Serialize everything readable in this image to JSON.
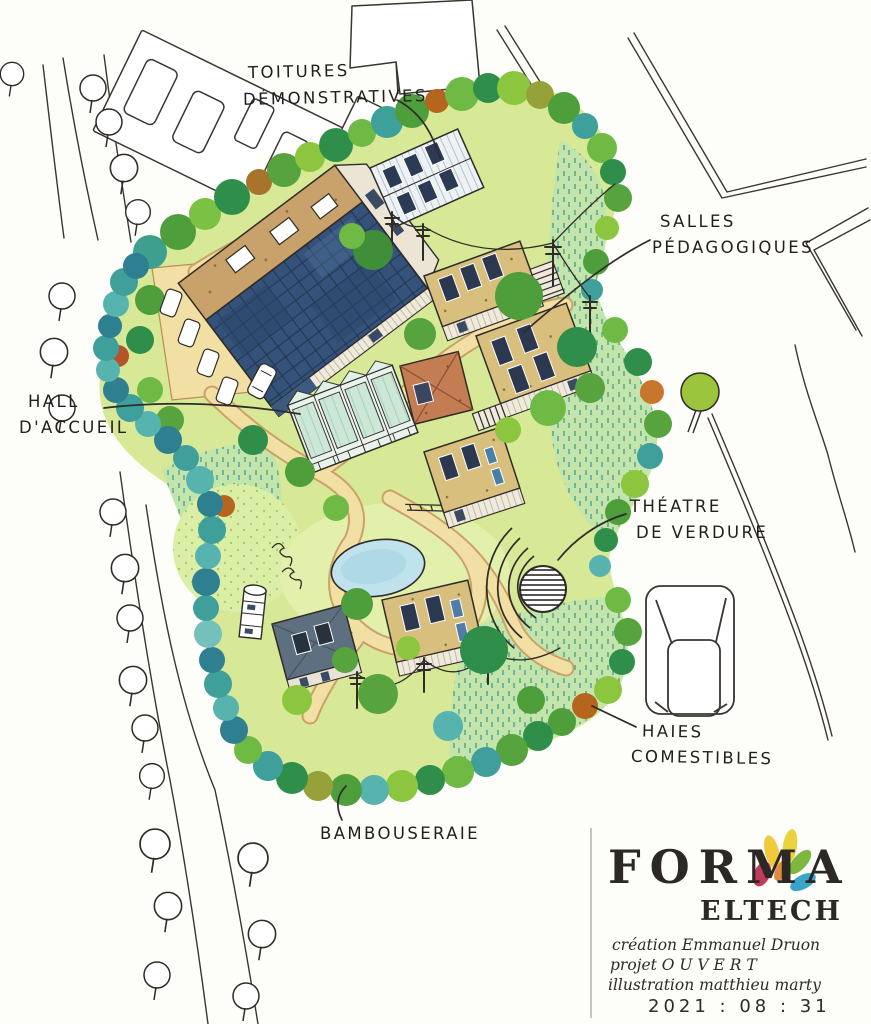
{
  "annotations": {
    "toitures": {
      "line1": "TOITURES",
      "line2": "DÉMONSTRATIVES"
    },
    "salles": {
      "line1": "SALLES",
      "line2": "PÉDAGOGIQUES"
    },
    "hall": {
      "line1": "HALL",
      "line2": "D'ACCUEIL"
    },
    "theatre": {
      "line1": "THÉATRE",
      "line2": "DE VERDURE"
    },
    "haies": {
      "line1": "HAIES",
      "line2": "COMESTIBLES"
    },
    "bambouseraie": {
      "line1": "BAMBOUSERAIE"
    }
  },
  "logo": {
    "brand": "FORMA",
    "sub": "ELTECH"
  },
  "credits": {
    "line1": "création Emmanuel Druon",
    "line2": "projet O U V E R T",
    "line3": "illustration matthieu marty",
    "line4": "2021 : 08 : 31"
  },
  "colors": {
    "ink": "#2f2b28",
    "campus_green": "#d7e897",
    "path_sand": "#f1dfa3",
    "pond_blue": "#bfe2ec",
    "solar_roof_blue": "#35537a",
    "thatch_roof_tan": "#d8bf7d",
    "terracotta": "#c47c52",
    "bamboo_teal": "#3f9f9b",
    "logo_leaf_colors": [
      "#f0c93c",
      "#c13b5a",
      "#7cb83e",
      "#3aa5c9",
      "#e08a3c"
    ]
  }
}
